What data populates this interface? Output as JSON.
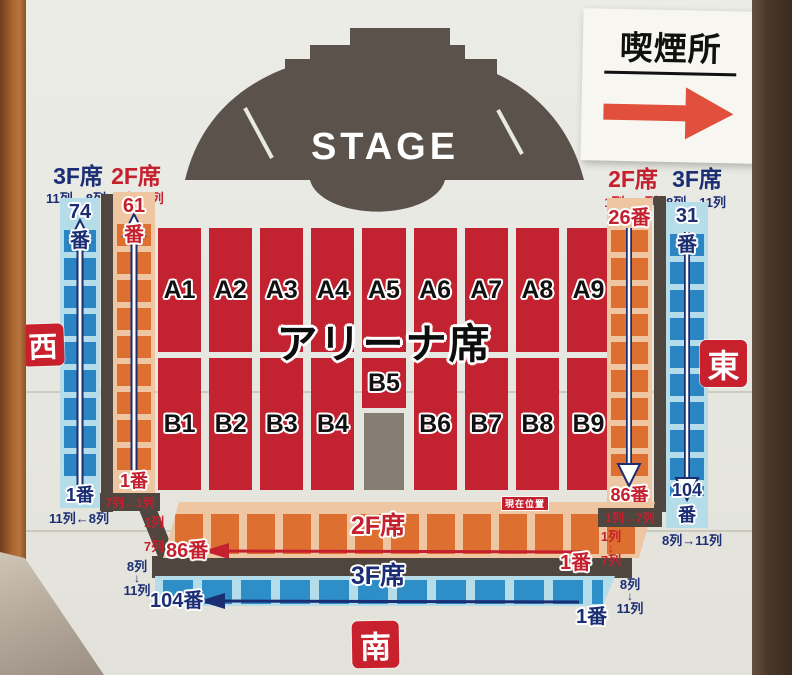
{
  "stage": {
    "label": "STAGE"
  },
  "smoking_sign": {
    "title": "喫煙所"
  },
  "badges": {
    "west": "西",
    "east": "東",
    "south": "南"
  },
  "arena": {
    "title": "アリーナ席",
    "blocks_a": [
      "A1",
      "A2",
      "A3",
      "A4",
      "A5",
      "A6",
      "A7",
      "A8",
      "A9"
    ],
    "blocks_b": [
      "B1",
      "B2",
      "B3",
      "B4",
      "B5",
      "B6",
      "B7",
      "B8",
      "B9"
    ],
    "current_location": "現在位置"
  },
  "west": {
    "f3": {
      "header": "3F席",
      "range": "11列←8列",
      "start_no": "74番",
      "end_no": "1番",
      "end_range": "11列←8列"
    },
    "f2": {
      "header": "2F席",
      "range": "7列←1列",
      "start_no": "61番",
      "end_no": "1番",
      "end_range": "7列←1列"
    }
  },
  "east": {
    "f2": {
      "header": "2F席",
      "range": "1列→7列",
      "start_no": "26番",
      "end_no": "86番",
      "end_range": "1列→7列"
    },
    "f3": {
      "header": "3F席",
      "range": "8列→11列",
      "start_no": "31番",
      "end_no": "104番",
      "end_range": "8列→11列"
    }
  },
  "south": {
    "f2": {
      "label": "2F席",
      "far_no": "86番",
      "near_no": "1番",
      "row_first": "1列",
      "arrow": "↓",
      "row_last": "7列"
    },
    "f3": {
      "label": "3F席",
      "far_no": "104番",
      "near_no": "1番",
      "row_first": "8列",
      "arrow": "↓",
      "row_last": "11列"
    }
  },
  "colors": {
    "arena_red": "#c32330",
    "stand_orange": "#dd7030",
    "stand_peach": "#eec6a2",
    "stand_blue": "#2e8fc8",
    "stand_light_blue": "#b5dde9",
    "navy_text": "#1b2d73",
    "red_text": "#c5202e",
    "dark_gray": "#4f463f",
    "stage_gray": "#5a524b",
    "badge_red": "#c8202c",
    "sign_arrow_red": "#e0503c"
  }
}
